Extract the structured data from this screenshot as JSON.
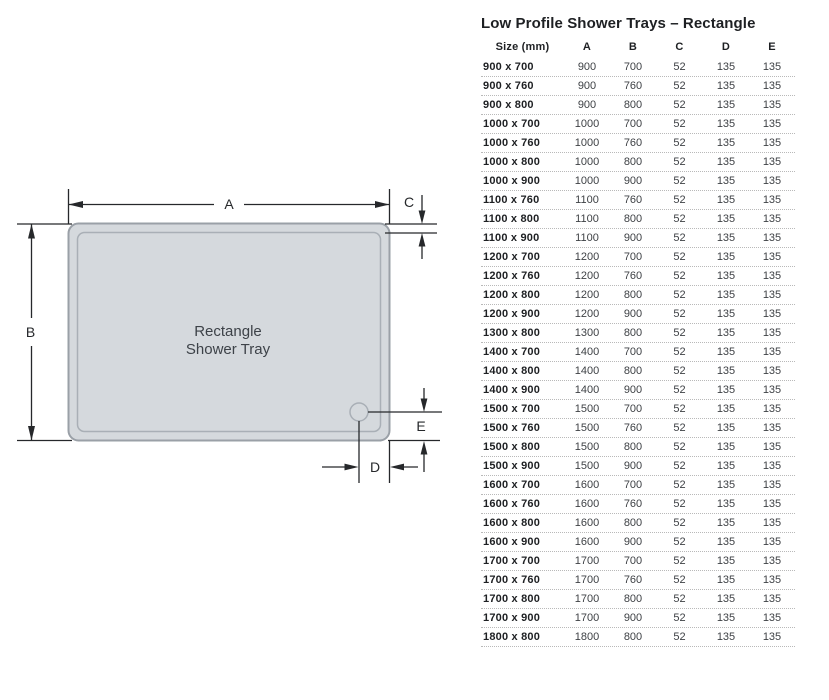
{
  "title": "Low Profile Shower Trays – Rectangle",
  "diagram": {
    "tray_label": {
      "line1": "Rectangle",
      "line2": "Shower Tray"
    },
    "labels": {
      "a": "A",
      "b": "B",
      "c": "C",
      "d": "D",
      "e": "E"
    },
    "colors": {
      "tray_fill": "#d5d9dd",
      "tray_stroke": "#9aa0a7",
      "tray_inner_stroke": "#a9afb6",
      "dimension_line": "#26282b",
      "tray_text": "#3d4248"
    }
  },
  "table": {
    "columns": [
      "Size (mm)",
      "A",
      "B",
      "C",
      "D",
      "E"
    ],
    "rows": [
      [
        "900 x 700",
        "900",
        "700",
        "52",
        "135",
        "135"
      ],
      [
        "900 x 760",
        "900",
        "760",
        "52",
        "135",
        "135"
      ],
      [
        "900 x 800",
        "900",
        "800",
        "52",
        "135",
        "135"
      ],
      [
        "1000 x 700",
        "1000",
        "700",
        "52",
        "135",
        "135"
      ],
      [
        "1000 x 760",
        "1000",
        "760",
        "52",
        "135",
        "135"
      ],
      [
        "1000 x 800",
        "1000",
        "800",
        "52",
        "135",
        "135"
      ],
      [
        "1000 x 900",
        "1000",
        "900",
        "52",
        "135",
        "135"
      ],
      [
        "1100 x 760",
        "1100",
        "760",
        "52",
        "135",
        "135"
      ],
      [
        "1100 x 800",
        "1100",
        "800",
        "52",
        "135",
        "135"
      ],
      [
        "1100 x 900",
        "1100",
        "900",
        "52",
        "135",
        "135"
      ],
      [
        "1200 x 700",
        "1200",
        "700",
        "52",
        "135",
        "135"
      ],
      [
        "1200 x 760",
        "1200",
        "760",
        "52",
        "135",
        "135"
      ],
      [
        "1200 x 800",
        "1200",
        "800",
        "52",
        "135",
        "135"
      ],
      [
        "1200 x 900",
        "1200",
        "900",
        "52",
        "135",
        "135"
      ],
      [
        "1300 x 800",
        "1300",
        "800",
        "52",
        "135",
        "135"
      ],
      [
        "1400 x 700",
        "1400",
        "700",
        "52",
        "135",
        "135"
      ],
      [
        "1400 x 800",
        "1400",
        "800",
        "52",
        "135",
        "135"
      ],
      [
        "1400 x 900",
        "1400",
        "900",
        "52",
        "135",
        "135"
      ],
      [
        "1500 x 700",
        "1500",
        "700",
        "52",
        "135",
        "135"
      ],
      [
        "1500 x 760",
        "1500",
        "760",
        "52",
        "135",
        "135"
      ],
      [
        "1500 x 800",
        "1500",
        "800",
        "52",
        "135",
        "135"
      ],
      [
        "1500 x 900",
        "1500",
        "900",
        "52",
        "135",
        "135"
      ],
      [
        "1600 x 700",
        "1600",
        "700",
        "52",
        "135",
        "135"
      ],
      [
        "1600 x 760",
        "1600",
        "760",
        "52",
        "135",
        "135"
      ],
      [
        "1600 x 800",
        "1600",
        "800",
        "52",
        "135",
        "135"
      ],
      [
        "1600 x 900",
        "1600",
        "900",
        "52",
        "135",
        "135"
      ],
      [
        "1700 x 700",
        "1700",
        "700",
        "52",
        "135",
        "135"
      ],
      [
        "1700 x 760",
        "1700",
        "760",
        "52",
        "135",
        "135"
      ],
      [
        "1700 x 800",
        "1700",
        "800",
        "52",
        "135",
        "135"
      ],
      [
        "1700 x 900",
        "1700",
        "900",
        "52",
        "135",
        "135"
      ],
      [
        "1800 x 800",
        "1800",
        "800",
        "52",
        "135",
        "135"
      ]
    ]
  }
}
